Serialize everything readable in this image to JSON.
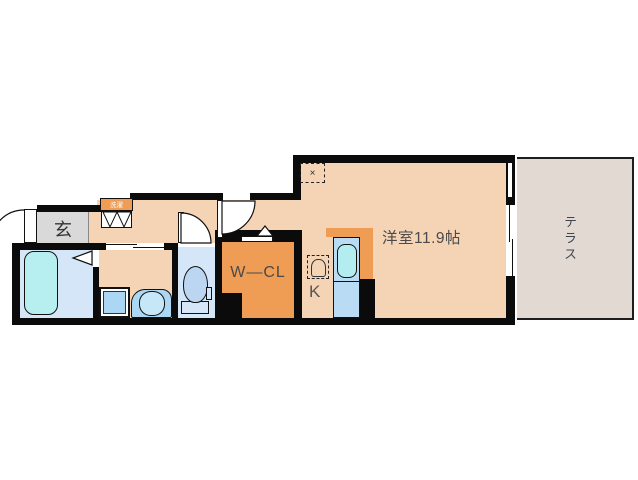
{
  "plan": {
    "rooms": {
      "main_room": {
        "label": "洋室11.9帖"
      },
      "terrace": {
        "label": "テラス"
      },
      "walk_in_closet": {
        "label": "W―CL"
      },
      "kitchen": {
        "label": "K"
      },
      "entrance": {
        "label": "玄"
      },
      "laundry_storage": {
        "label": "洗濯"
      }
    },
    "marks": {
      "ceiling_light": "×"
    },
    "colors": {
      "wall": "#0b0b0b",
      "floor": "#f5d3b5",
      "closet_orange": "#ef9c55",
      "terrace_gray": "#e2dad2",
      "entrance_gray": "#d9d9d9",
      "wet_floor_blue": "#d4e6f8",
      "fixture_blue": "#abd7f5",
      "tub_cyan": "#b7eff1",
      "kitchen_blue": "#badbf4",
      "sink_cyan": "#b3edf0",
      "label_text": "#4a4a4a"
    },
    "icons": [
      "bathtub-icon",
      "toilet-icon",
      "washbasin-icon",
      "washing-machine-pan-icon",
      "kitchen-sink-icon",
      "refrigerator-space-icon",
      "ceiling-light-icon",
      "door-swing-icon",
      "sliding-door-icon",
      "folding-door-icon",
      "window-icon"
    ]
  }
}
